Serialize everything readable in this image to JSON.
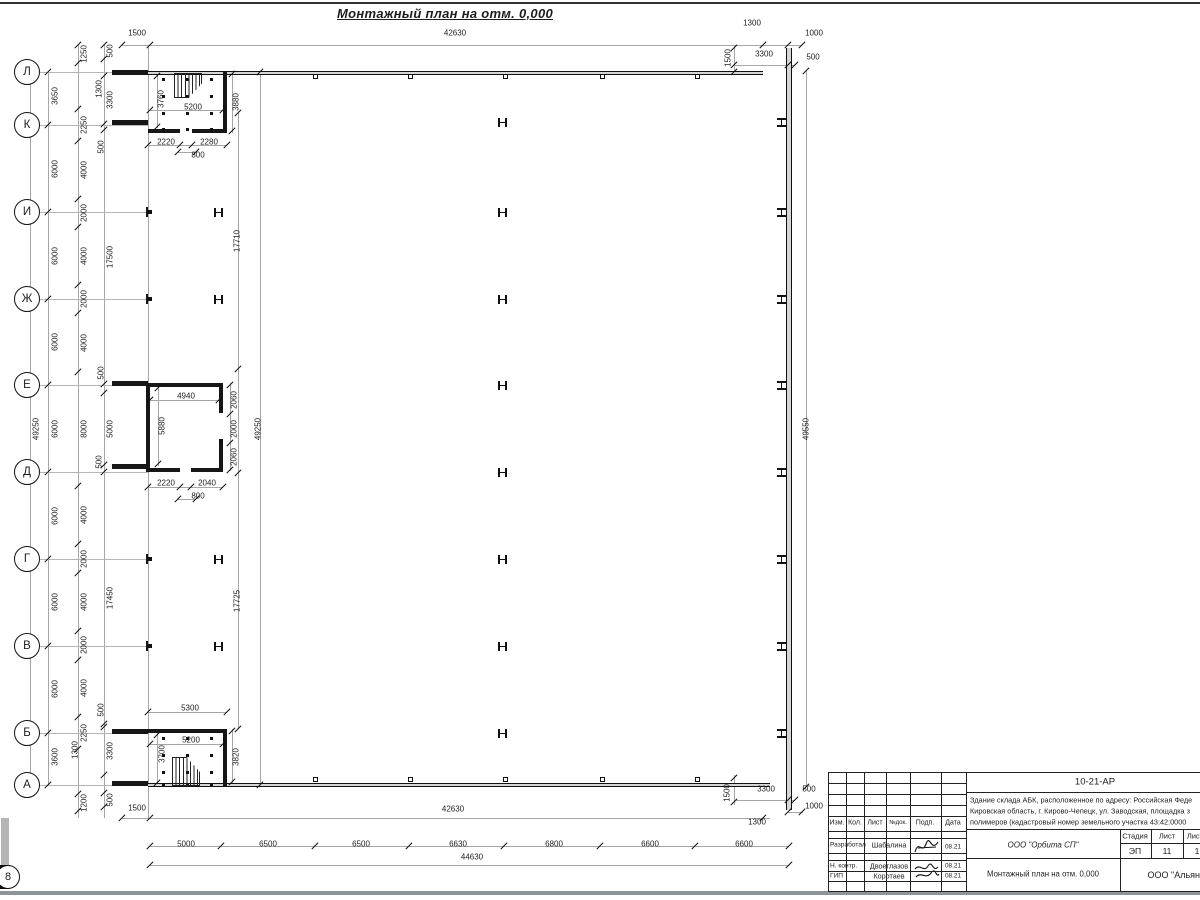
{
  "sheet": {
    "plan_title": "Монтажный план на отм. 0,000"
  },
  "drawing": {
    "row_axes": [
      [
        "Л",
        72
      ],
      [
        "К",
        125
      ],
      [
        "И",
        212
      ],
      [
        "Ж",
        299
      ],
      [
        "Е",
        385
      ],
      [
        "Д",
        472
      ],
      [
        "Г",
        559
      ],
      [
        "В",
        646
      ],
      [
        "Б",
        733
      ],
      [
        "А",
        785
      ]
    ],
    "col_axes": [
      [
        "1",
        150
      ],
      [
        "2",
        221
      ],
      [
        "3",
        315
      ],
      [
        "4",
        409
      ],
      [
        "5",
        504
      ],
      [
        "6",
        600
      ],
      [
        "7",
        695
      ],
      [
        "8",
        789
      ]
    ],
    "labels": [
      [
        "1500",
        137,
        33
      ],
      [
        "42630",
        455,
        33
      ],
      [
        "1300",
        752,
        23
      ],
      [
        "1000",
        814,
        33
      ],
      [
        "1500",
        728,
        58,
        1
      ],
      [
        "3300",
        764,
        54
      ],
      [
        "500",
        813,
        57
      ],
      [
        "49250",
        36,
        429,
        1
      ],
      [
        "3650",
        55,
        96,
        1
      ],
      [
        "6000",
        55,
        169,
        1
      ],
      [
        "6000",
        55,
        256,
        1
      ],
      [
        "6000",
        55,
        342,
        1
      ],
      [
        "6000",
        55,
        429,
        1
      ],
      [
        "6000",
        55,
        516,
        1
      ],
      [
        "6000",
        55,
        602,
        1
      ],
      [
        "6000",
        55,
        689,
        1
      ],
      [
        "3600",
        55,
        757,
        1
      ],
      [
        "1250",
        84,
        54,
        1
      ],
      [
        "2250",
        84,
        125,
        1
      ],
      [
        "4000",
        84,
        170,
        1
      ],
      [
        "2000",
        84,
        213,
        1
      ],
      [
        "4000",
        84,
        256,
        1
      ],
      [
        "2000",
        84,
        299,
        1
      ],
      [
        "4000",
        84,
        343,
        1
      ],
      [
        "8000",
        84,
        429,
        1
      ],
      [
        "4000",
        84,
        515,
        1
      ],
      [
        "2000",
        84,
        559,
        1
      ],
      [
        "4000",
        84,
        602,
        1
      ],
      [
        "2000",
        84,
        645,
        1
      ],
      [
        "4000",
        84,
        688,
        1
      ],
      [
        "2250",
        84,
        733,
        1
      ],
      [
        "1200",
        84,
        803,
        1
      ],
      [
        "500",
        110,
        51,
        1
      ],
      [
        "3300",
        110,
        100,
        1
      ],
      [
        "17500",
        110,
        257,
        1
      ],
      [
        "5000",
        110,
        429,
        1
      ],
      [
        "17450",
        110,
        598,
        1
      ],
      [
        "3300",
        110,
        751,
        1
      ],
      [
        "500",
        110,
        800,
        1
      ],
      [
        "1300",
        99,
        89,
        1
      ],
      [
        "500",
        101,
        147,
        1
      ],
      [
        "500",
        101,
        373,
        1
      ],
      [
        "500",
        99,
        462,
        1
      ],
      [
        "500",
        101,
        710,
        1
      ],
      [
        "1300",
        75,
        750,
        1
      ],
      [
        "3760",
        161,
        99,
        1
      ],
      [
        "5200",
        193,
        107
      ],
      [
        "3880",
        236,
        102,
        1
      ],
      [
        "2220",
        166,
        142
      ],
      [
        "2280",
        209,
        142
      ],
      [
        "800",
        198,
        155
      ],
      [
        "17710",
        237,
        241,
        1
      ],
      [
        "49250",
        258,
        429,
        1
      ],
      [
        "17725",
        237,
        601,
        1
      ],
      [
        "49550",
        806,
        429,
        1
      ],
      [
        "4940",
        186,
        396
      ],
      [
        "5880",
        162,
        426,
        1
      ],
      [
        "2060",
        234,
        400,
        1
      ],
      [
        "2000",
        234,
        429,
        1
      ],
      [
        "2060",
        234,
        457,
        1
      ],
      [
        "2220",
        166,
        483
      ],
      [
        "2040",
        207,
        483
      ],
      [
        "800",
        198,
        496
      ],
      [
        "5300",
        190,
        708
      ],
      [
        "5200",
        191,
        740
      ],
      [
        "3700",
        162,
        754,
        1
      ],
      [
        "3820",
        236,
        757,
        1
      ],
      [
        "1500",
        137,
        808
      ],
      [
        "42630",
        453,
        809
      ],
      [
        "5000",
        186,
        844
      ],
      [
        "6500",
        268,
        844
      ],
      [
        "6500",
        361,
        844
      ],
      [
        "6630",
        458,
        844
      ],
      [
        "6800",
        554,
        844
      ],
      [
        "6600",
        650,
        844
      ],
      [
        "6600",
        744,
        844
      ],
      [
        "44630",
        472,
        857
      ],
      [
        "1500",
        727,
        793,
        1
      ],
      [
        "3300",
        766,
        789
      ],
      [
        "500",
        809,
        789
      ],
      [
        "1000",
        814,
        806
      ],
      [
        "1300",
        757,
        822
      ]
    ],
    "lines": [
      [
        122,
        45,
        680,
        1
      ],
      [
        734,
        45,
        1,
        30
      ],
      [
        734,
        65,
        61,
        1
      ],
      [
        30,
        72,
        1,
        713
      ],
      [
        48,
        72,
        1,
        713
      ],
      [
        78,
        45,
        1,
        773
      ],
      [
        104,
        45,
        1,
        773
      ],
      [
        148,
        45,
        1,
        773
      ],
      [
        238,
        113,
        1,
        616
      ],
      [
        260,
        72,
        1,
        713
      ],
      [
        806,
        71,
        1,
        716
      ],
      [
        150,
        110,
        73,
        1
      ],
      [
        148,
        145,
        79,
        1
      ],
      [
        178,
        152,
        18,
        1
      ],
      [
        157,
        74,
        1,
        54
      ],
      [
        232,
        72,
        1,
        61
      ],
      [
        150,
        400,
        69,
        1
      ],
      [
        158,
        386,
        1,
        80
      ],
      [
        230,
        383,
        1,
        88
      ],
      [
        148,
        487,
        75,
        1
      ],
      [
        178,
        499,
        18,
        1
      ],
      [
        148,
        712,
        79,
        1
      ],
      [
        150,
        744,
        73,
        1
      ],
      [
        157,
        733,
        1,
        53
      ],
      [
        232,
        729,
        1,
        55
      ],
      [
        122,
        818,
        648,
        1
      ],
      [
        150,
        846,
        639,
        1
      ],
      [
        150,
        865,
        639,
        1
      ],
      [
        734,
        775,
        1,
        30
      ],
      [
        734,
        800,
        61,
        1
      ],
      [
        788,
        812,
        15,
        1
      ]
    ],
    "walls": [
      [
        112,
        70,
        36,
        4.5
      ],
      [
        112,
        120,
        36,
        4.5
      ],
      [
        112,
        381,
        36,
        4.5
      ],
      [
        112,
        464,
        36,
        4.5
      ],
      [
        112,
        729,
        36,
        4.5
      ],
      [
        112,
        781,
        36,
        4.5
      ],
      [
        223,
        72,
        4,
        60
      ],
      [
        148,
        129,
        32,
        4
      ],
      [
        192,
        129,
        35,
        4
      ],
      [
        146,
        383,
        3.5,
        89
      ],
      [
        148,
        383,
        73,
        3.5
      ],
      [
        219,
        383,
        4,
        30
      ],
      [
        219,
        442,
        4,
        30
      ],
      [
        148,
        468,
        32,
        4
      ],
      [
        191,
        468,
        32,
        4
      ],
      [
        148,
        729,
        79,
        3.5
      ],
      [
        223,
        731,
        4,
        56
      ],
      [
        146,
        207,
        2,
        10
      ],
      [
        146,
        294,
        2,
        10
      ],
      [
        146,
        554,
        2,
        10
      ],
      [
        146,
        641,
        2,
        10
      ]
    ],
    "dwalls": [
      [
        148,
        70.5,
        615,
        4,
        "h"
      ],
      [
        148,
        783,
        622,
        4,
        "h"
      ],
      [
        786,
        48,
        6,
        762,
        "v"
      ]
    ],
    "ticks": [
      [
        122,
        45
      ],
      [
        150,
        45
      ],
      [
        763,
        45
      ],
      [
        788,
        45
      ],
      [
        802,
        45
      ],
      [
        734,
        48
      ],
      [
        734,
        72
      ],
      [
        734,
        65
      ],
      [
        788,
        65
      ],
      [
        795,
        65
      ],
      [
        48,
        72
      ],
      [
        48,
        125
      ],
      [
        48,
        212
      ],
      [
        48,
        299
      ],
      [
        48,
        385
      ],
      [
        48,
        472
      ],
      [
        48,
        559
      ],
      [
        48,
        646
      ],
      [
        48,
        733
      ],
      [
        48,
        785
      ],
      [
        30,
        72
      ],
      [
        30,
        785
      ],
      [
        78,
        45
      ],
      [
        78,
        63
      ],
      [
        78,
        109
      ],
      [
        78,
        141
      ],
      [
        78,
        199
      ],
      [
        78,
        227
      ],
      [
        78,
        285
      ],
      [
        78,
        313
      ],
      [
        78,
        372
      ],
      [
        78,
        486
      ],
      [
        78,
        544
      ],
      [
        78,
        573
      ],
      [
        78,
        631
      ],
      [
        78,
        660
      ],
      [
        78,
        717
      ],
      [
        78,
        749
      ],
      [
        78,
        794
      ],
      [
        78,
        811
      ],
      [
        104,
        45
      ],
      [
        104,
        59
      ],
      [
        104,
        76
      ],
      [
        104,
        124
      ],
      [
        104,
        130
      ],
      [
        104,
        384
      ],
      [
        104,
        393
      ],
      [
        104,
        465
      ],
      [
        104,
        472
      ],
      [
        104,
        724
      ],
      [
        104,
        727
      ],
      [
        104,
        775
      ],
      [
        104,
        793
      ],
      [
        104,
        807
      ],
      [
        238,
        113
      ],
      [
        238,
        369
      ],
      [
        238,
        473
      ],
      [
        238,
        729
      ],
      [
        260,
        72
      ],
      [
        260,
        785
      ],
      [
        806,
        71
      ],
      [
        806,
        787
      ],
      [
        150,
        110
      ],
      [
        223,
        110
      ],
      [
        148,
        145
      ],
      [
        180,
        145
      ],
      [
        192,
        145
      ],
      [
        227,
        145
      ],
      [
        178,
        152
      ],
      [
        196,
        152
      ],
      [
        157,
        76
      ],
      [
        157,
        127
      ],
      [
        232,
        74
      ],
      [
        232,
        131
      ],
      [
        150,
        400
      ],
      [
        219,
        400
      ],
      [
        158,
        388
      ],
      [
        158,
        464
      ],
      [
        230,
        385
      ],
      [
        230,
        414
      ],
      [
        230,
        443
      ],
      [
        230,
        470
      ],
      [
        148,
        487
      ],
      [
        180,
        487
      ],
      [
        191,
        487
      ],
      [
        223,
        487
      ],
      [
        178,
        499
      ],
      [
        196,
        499
      ],
      [
        148,
        712
      ],
      [
        227,
        712
      ],
      [
        150,
        744
      ],
      [
        223,
        744
      ],
      [
        157,
        735
      ],
      [
        157,
        783
      ],
      [
        232,
        731
      ],
      [
        232,
        782
      ],
      [
        122,
        818
      ],
      [
        150,
        818
      ],
      [
        763,
        818
      ],
      [
        150,
        846
      ],
      [
        221,
        846
      ],
      [
        315,
        846
      ],
      [
        409,
        846
      ],
      [
        504,
        846
      ],
      [
        600,
        846
      ],
      [
        695,
        846
      ],
      [
        789,
        846
      ],
      [
        150,
        865
      ],
      [
        789,
        865
      ],
      [
        734,
        778
      ],
      [
        734,
        802
      ],
      [
        788,
        800
      ],
      [
        795,
        800
      ],
      [
        788,
        812
      ],
      [
        802,
        812
      ]
    ],
    "hcols": [
      [
        498,
        118
      ],
      [
        498,
        208
      ],
      [
        498,
        295
      ],
      [
        498,
        381
      ],
      [
        498,
        468
      ],
      [
        498,
        555
      ],
      [
        498,
        642
      ],
      [
        498,
        729
      ],
      [
        214,
        208
      ],
      [
        214,
        295
      ],
      [
        214,
        555
      ],
      [
        214,
        642
      ],
      [
        777,
        118,
        1
      ],
      [
        777,
        208,
        1
      ],
      [
        777,
        295,
        1
      ],
      [
        777,
        381,
        1
      ],
      [
        777,
        468,
        1
      ],
      [
        777,
        555,
        1
      ],
      [
        777,
        642,
        1
      ],
      [
        777,
        729,
        1
      ]
    ],
    "wsq": [
      [
        313,
        74
      ],
      [
        408,
        74
      ],
      [
        503,
        74
      ],
      [
        600,
        74
      ],
      [
        695,
        74
      ],
      [
        313,
        777
      ],
      [
        408,
        777
      ],
      [
        503,
        777
      ],
      [
        600,
        777
      ],
      [
        695,
        777
      ]
    ],
    "bsq": [
      [
        148,
        210
      ],
      [
        148,
        297
      ],
      [
        148,
        557
      ],
      [
        148,
        644
      ],
      [
        219,
        405
      ],
      [
        219,
        439
      ]
    ],
    "dots": [
      [
        162,
        78
      ],
      [
        186,
        78
      ],
      [
        210,
        78
      ],
      [
        162,
        95
      ],
      [
        186,
        95
      ],
      [
        210,
        95
      ],
      [
        162,
        112
      ],
      [
        186,
        112
      ],
      [
        210,
        112
      ],
      [
        162,
        128
      ],
      [
        186,
        128
      ],
      [
        210,
        128
      ],
      [
        162,
        737
      ],
      [
        186,
        737
      ],
      [
        210,
        737
      ],
      [
        162,
        754
      ],
      [
        186,
        754
      ],
      [
        210,
        754
      ],
      [
        162,
        771
      ],
      [
        186,
        771
      ],
      [
        210,
        771
      ],
      [
        162,
        783
      ],
      [
        186,
        783
      ],
      [
        210,
        783
      ]
    ],
    "stairs": [
      {
        "x": 174,
        "y": 73,
        "w": 28,
        "h": 25,
        "clip": "polygon(0 0,100% 0,100% 42%,52% 100%,0 100%)"
      },
      {
        "x": 172,
        "y": 757,
        "w": 28,
        "h": 29,
        "clip": "polygon(0 0,52% 0,100% 52%,100% 100%,0 100%)"
      }
    ]
  },
  "title_block": {
    "doc_code": "10-21-АР",
    "desc1": "Здание склада АБК, расположенное по адресу: Российская Феде",
    "desc2": "Кировская область, г. Кирово-Чепецк, ул. Заводская, площадка з",
    "desc3": "полимеров (кадастровый номер земельного участка 43:42:0000",
    "org": "ООО \"Орбита СП\"",
    "plan_name": "Монтажный план на отм. 0,000",
    "org2": "ООО \"Альянс",
    "stage_label": "Стадия",
    "sheet_label": "Лист",
    "sheets_label": "Листов",
    "stage": "ЭП",
    "sheet_no": "11",
    "sheets_no": "1",
    "head": {
      "izm": "Изм.",
      "kol": "Кол.",
      "list": "Лист",
      "ndok": "№док.",
      "podp": "Подп.",
      "data": "Дата"
    },
    "rows": [
      {
        "role": "Разработал",
        "name": "Шабалина",
        "date": "08.21"
      },
      {
        "role": "Н. контр.",
        "name": "Двоеглазов",
        "date": "08.21"
      },
      {
        "role": "ГИП",
        "name": "Коротаев",
        "date": "08.21"
      }
    ]
  }
}
